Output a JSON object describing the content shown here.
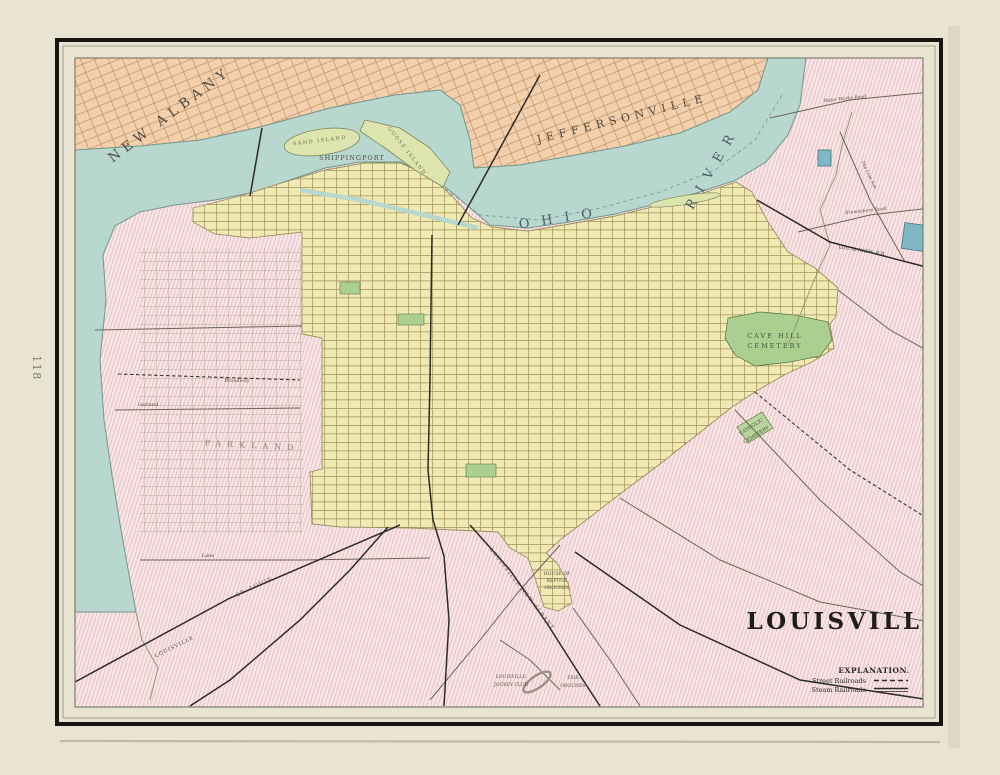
{
  "page": {
    "number": "118"
  },
  "map": {
    "title": "LOUISVILLE",
    "legend": {
      "heading": "EXPLANATION.",
      "items": [
        {
          "label": "Street Railroads",
          "symbol": "dashed"
        },
        {
          "label": "Steam Railroads",
          "symbol": "solid"
        }
      ]
    },
    "cities": {
      "new_albany": "NEW ALBANY",
      "jeffersonville": "JEFFERSONVILLE",
      "shippingport": "SHIPPINGPORT",
      "parkland": "PARKLAND"
    },
    "water": {
      "ohio": "OHIO",
      "river": "RIVER",
      "sand_island": "SAND ISLAND",
      "goose_island": "GOOSE ISLAND"
    },
    "places": {
      "cave_hill_line1": "CAVE HILL",
      "cave_hill_line2": "CEMETERY",
      "catholic_line1": "CATHOLIC",
      "catholic_line2": "CEMETERY",
      "refuge_line1": "HOUSE OF",
      "refuge_line2": "REFUGE",
      "refuge_line3": "GROUNDS",
      "jockey_line1": "LOUISVILLE",
      "jockey_line2": "JOCKEY CLUB",
      "fair_line1": "FAIR",
      "fair_line2": "GROUNDS"
    },
    "streets": {
      "broadway": "Broadway",
      "garland": "Garland",
      "lane": "Lane",
      "water_works": "Water Works Road",
      "brownsboro": "Brownsboro Road",
      "line_ave": "The Line Ave."
    },
    "railroads": {
      "lou_nash": "LOU. & NASH. R.R.",
      "lou_new_albany": "LOUISVILLE  NEW ALBANY",
      "st_louis": "ST. LOUIS",
      "louisville_rr": "LOUISVILLE"
    }
  },
  "colors": {
    "paper": "#e9e4d2",
    "frame": "#17150f",
    "county_pink": "#f7e6e5",
    "indiana_peach": "#f4cfab",
    "river_blue": "#b7d7cf",
    "city_yellow": "#efe9b4",
    "park_green": "#abcf90",
    "ink": "#3a342c"
  }
}
